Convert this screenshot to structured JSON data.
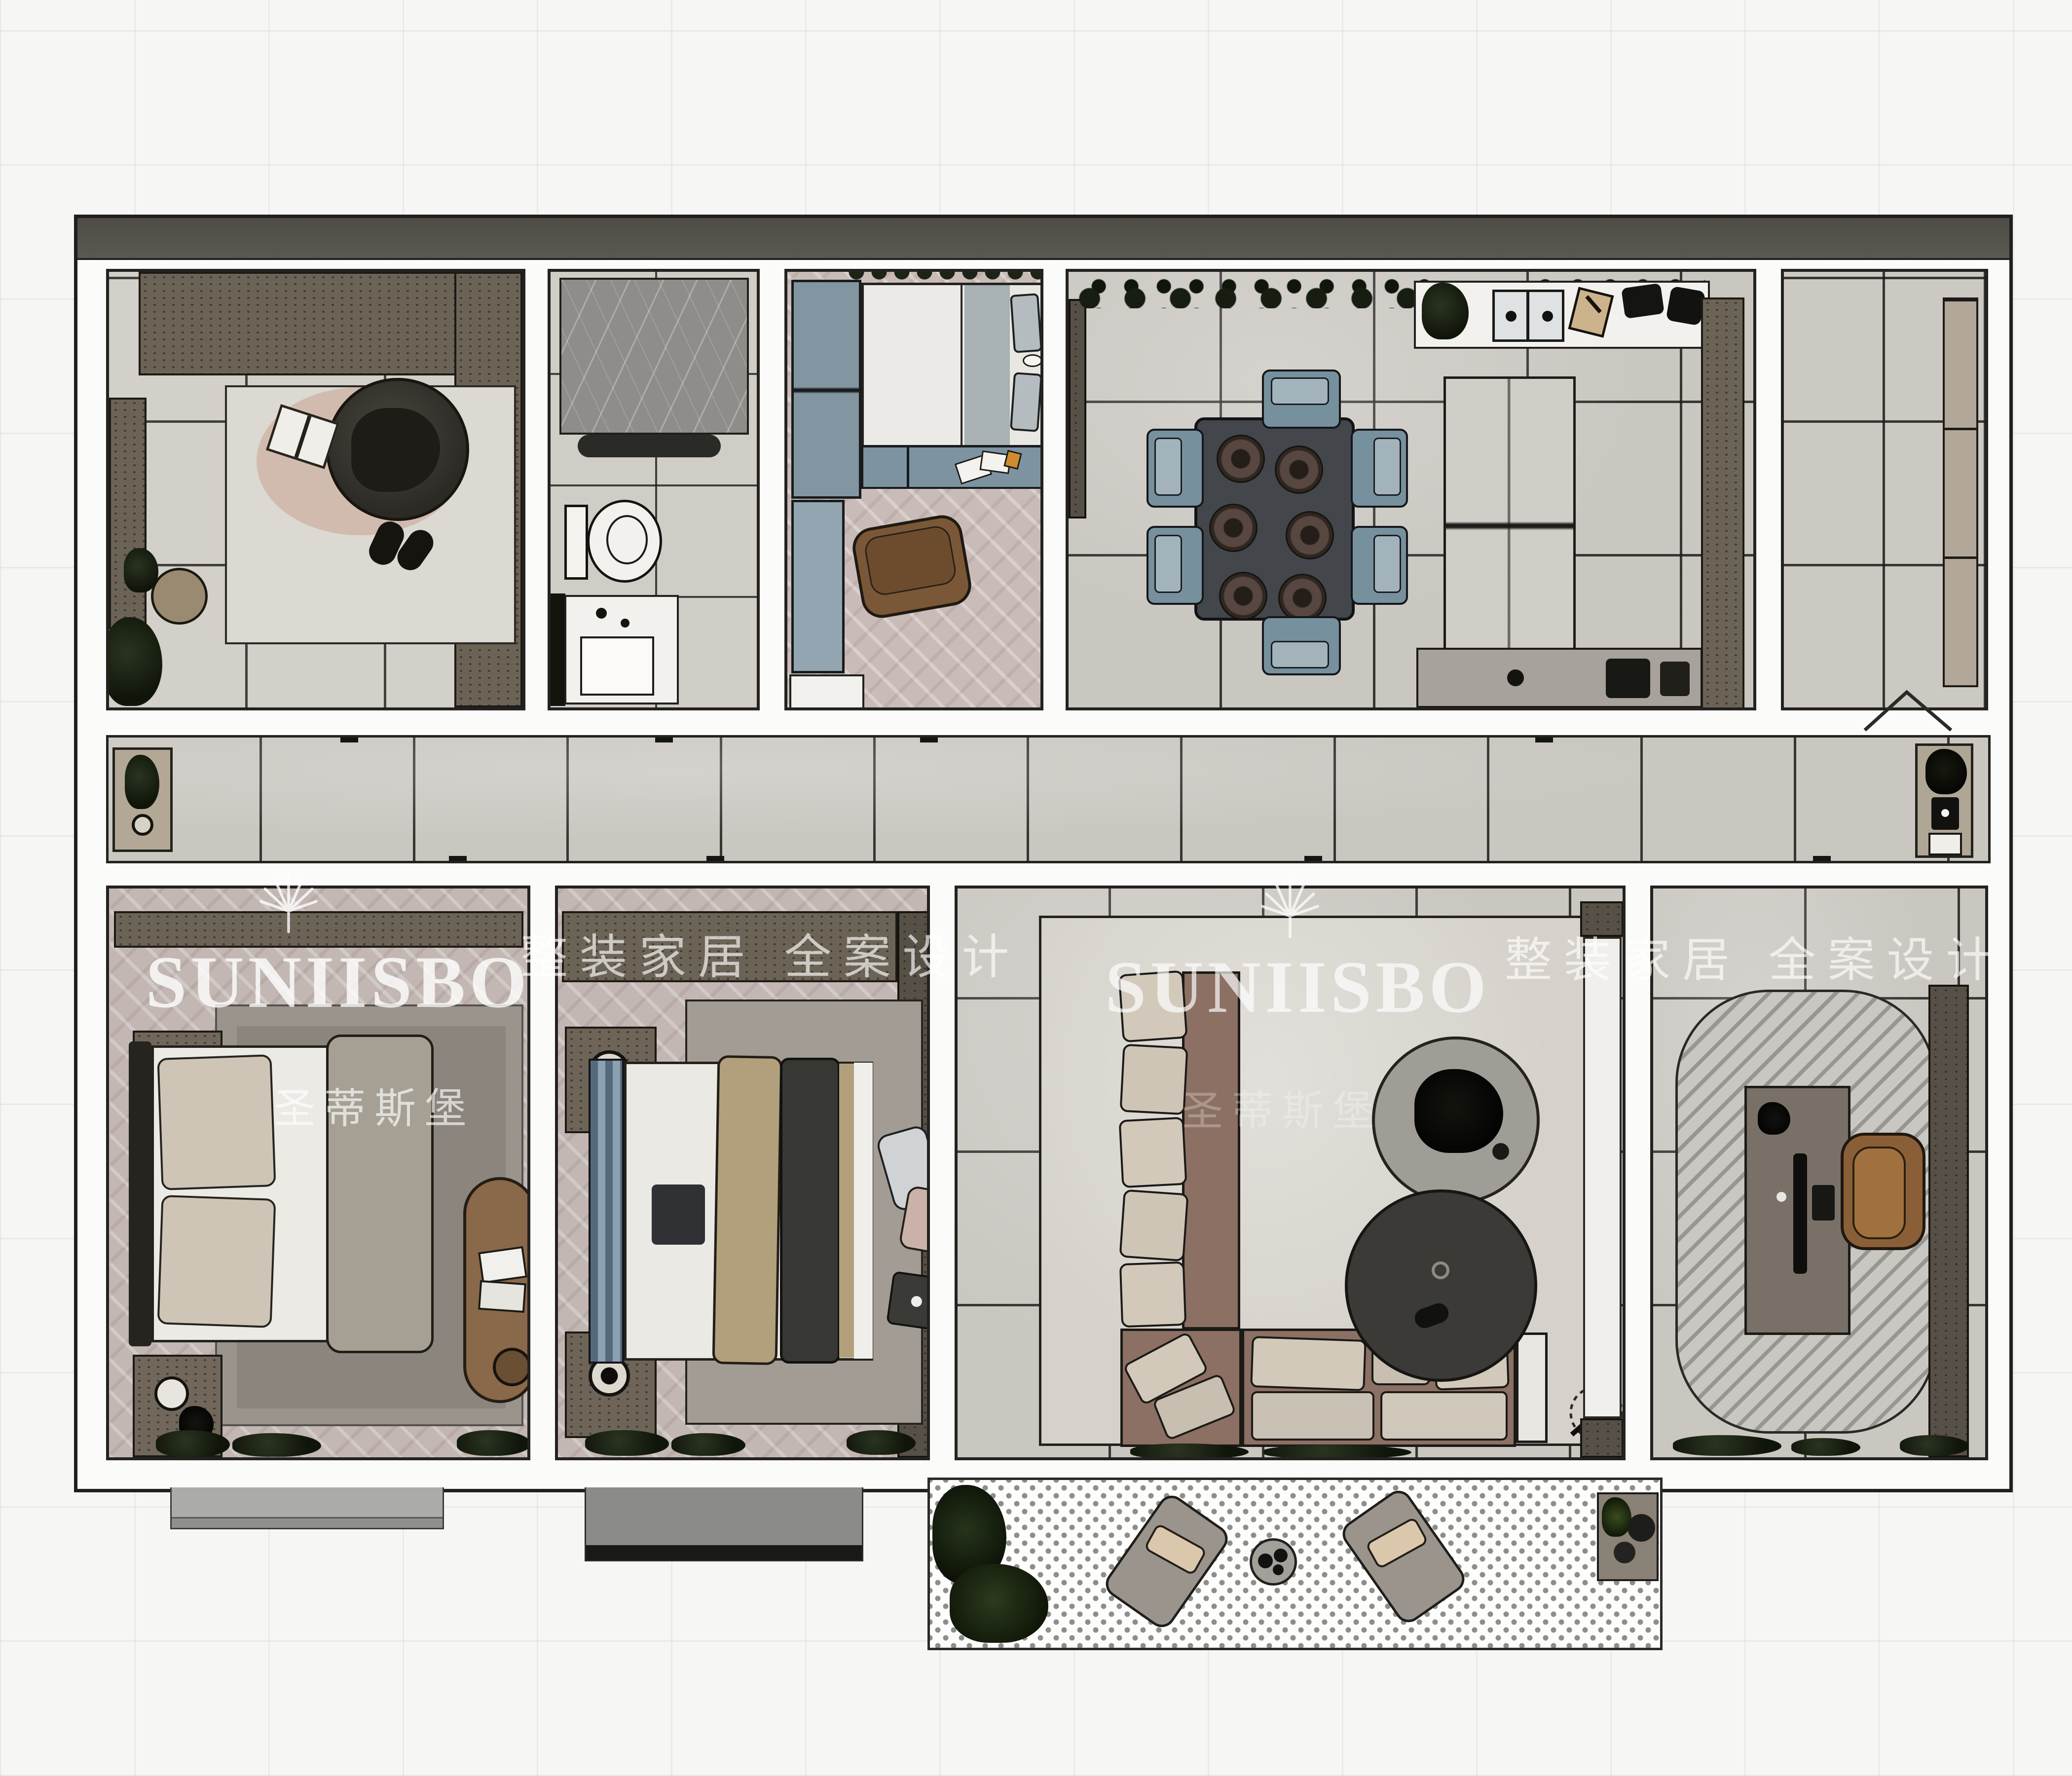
{
  "watermark": {
    "brand": "SUNIISBO",
    "brand_cn": "圣蒂斯堡",
    "tagline": "整装家居 全案设计"
  },
  "colors": {
    "wall_line": "#23221f",
    "wall_fill": "#fbfbfa",
    "tile_floor": "#cac6c0",
    "herringbone_floor": "#c2b7b3",
    "cabinet_brown": "#6c6357",
    "cabinet_dark": "#575047",
    "furniture_blue_gray": "#76909e",
    "sofa_mauve": "#8b7063",
    "cushion_cream": "#d2c9bb",
    "rug_gray": "#9a948d",
    "shower_marble": "#8f8d89",
    "wood_accent": "#8a5f38",
    "plant_dark": "#1a2112",
    "balcony_dot": "#8d8d8b",
    "watermark_white": "rgba(255,255,255,0.8)"
  },
  "rooms": [
    {
      "id": "cloakroom"
    },
    {
      "id": "bathroom"
    },
    {
      "id": "bedroom-3"
    },
    {
      "id": "dining-kitchen"
    },
    {
      "id": "utility-room"
    },
    {
      "id": "hallway"
    },
    {
      "id": "master-bedroom"
    },
    {
      "id": "bedroom-2"
    },
    {
      "id": "living-room"
    },
    {
      "id": "study"
    },
    {
      "id": "balcony"
    }
  ]
}
